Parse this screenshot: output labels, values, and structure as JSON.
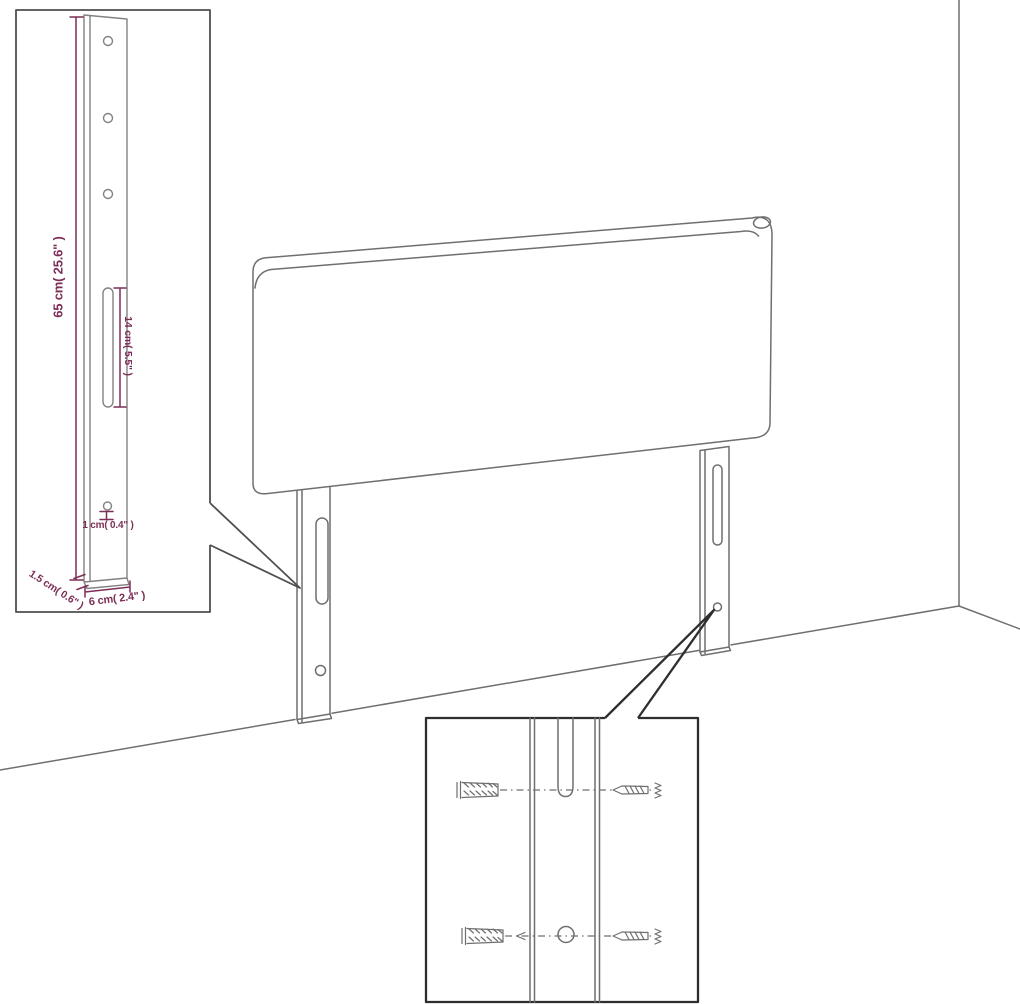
{
  "title": "Headboard mounting-leg dimension diagram",
  "dimensions": {
    "height": "65 cm( 25.6\" )",
    "slot": "14 cm( 5.5\" )",
    "hole": "1 cm( 0.4\" )",
    "thickness": "1.5 cm( 0.6\" )",
    "width": "6 cm( 2.4\" )"
  },
  "colors": {
    "background": "#ffffff",
    "drawing_line": "#6f6f6f",
    "inset_line": "#828282",
    "dimension": "#7d2e57",
    "inset_border": "#4f4f4f",
    "detail_border": "#2e2e2e"
  }
}
